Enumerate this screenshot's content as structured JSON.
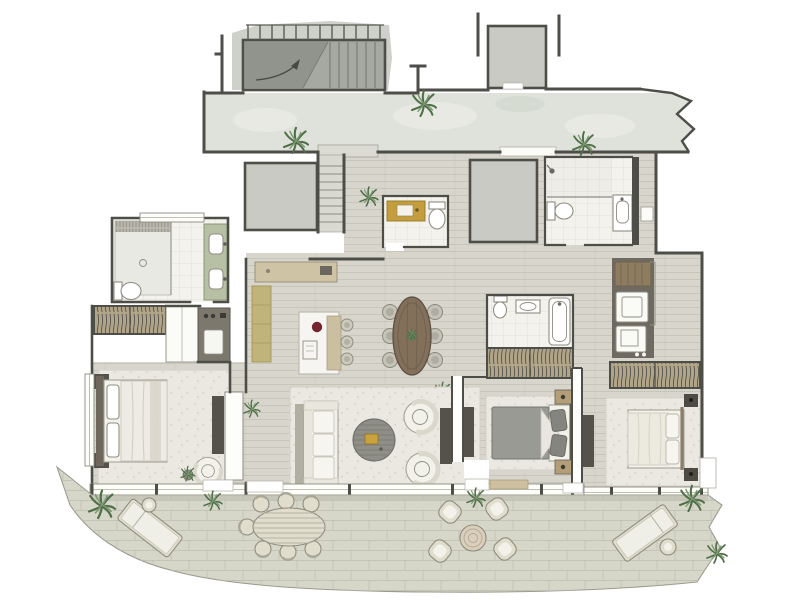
{
  "meta": {
    "type": "architectural-floor-plan",
    "style": "hand-rendered watercolor",
    "canvas": {
      "width": 800,
      "height": 600
    }
  },
  "palette": {
    "wall": "#4e4e48",
    "corridor": "#dee2da",
    "corridor_blotch": "#e8ebe3",
    "gray_block": "#c9cac4",
    "stair_light": "#ced1ca",
    "stair_gray": "#a6a8a2",
    "stair_dark": "#8f918b",
    "wood": "#d8d6cc",
    "plank_line": "#c3c1b5",
    "bath_floor": "#f3f2ed",
    "tile_line": "#dcdad1",
    "green_vanity": "#b7c0a5",
    "yellow_cabinet": "#c0b478",
    "gold_vanity": "#c49d3f",
    "wood_console": "#cfc3a5",
    "island_wood": "#cabfa0",
    "marble": "#f6f5f1",
    "red_bowl": "#74252d",
    "rug": "#eae8e1",
    "speckle": "#cfcdc2",
    "dark_furniture": "#55524b",
    "gray_furniture": "#90908a",
    "bed_white": "#f2f1ea",
    "duvet_gray": "#9a9a94",
    "headboard": "#6f675c",
    "night_tan": "#b49e78",
    "table_wood": "#82705a",
    "chair_gray": "#c6c3b8",
    "terrace": "#d7d7c9",
    "brick_line": "#bcbfae",
    "wicker": "#e0ddcd",
    "closet_tan": "#b0a489",
    "hatch": "#57554d",
    "utility_dark": "#6e6a61",
    "appliance_wood": "#8d7c5f",
    "tray_gold": "#c9a23d",
    "plant_dark": "#4f6f48",
    "plant_light": "#7b9770"
  },
  "plan": {
    "rooms": [
      {
        "name": "Stairwell",
        "furniture": [
          "staircase",
          "railing",
          "direction-arrow"
        ]
      },
      {
        "name": "Shared corridor",
        "furniture": [
          "plant",
          "plant",
          "plant"
        ]
      },
      {
        "name": "Entry hall",
        "furniture": [
          "entry-steps",
          "threshold",
          "plant",
          "shaft-block",
          "shaft-block"
        ]
      },
      {
        "name": "Powder room",
        "furniture": [
          "gold-vanity",
          "toilet"
        ]
      },
      {
        "name": "Guest bathroom",
        "furniture": [
          "shower",
          "toilet",
          "vanity"
        ]
      },
      {
        "name": "Master bathroom",
        "furniture": [
          "walk-in-shower",
          "bench",
          "toilet",
          "double-vanity"
        ]
      },
      {
        "name": "Master bedroom",
        "furniture": [
          "double-bed",
          "nightstand",
          "nightstand",
          "rug",
          "tv-console",
          "armchair",
          "plant",
          "wardrobe",
          "minibar-cabinet",
          "linen-closet"
        ]
      },
      {
        "name": "Kitchen and dining",
        "furniture": [
          "wall-console",
          "tall-cabinet",
          "kitchen-island",
          "bar-stool",
          "bar-stool",
          "bar-stool",
          "oval-dining-table",
          "dining-chairs-x6"
        ]
      },
      {
        "name": "Living room",
        "furniture": [
          "sofa",
          "side-console",
          "round-coffee-table",
          "tray",
          "barrel-armchair",
          "barrel-armchair",
          "rug",
          "media-console",
          "plant"
        ]
      },
      {
        "name": "Bedroom 2",
        "furniture": [
          "double-bed",
          "nightstand",
          "nightstand",
          "rug",
          "tv-console",
          "wardrobe"
        ]
      },
      {
        "name": "En-suite bathroom",
        "furniture": [
          "toilet",
          "vanity",
          "bathtub"
        ]
      },
      {
        "name": "Bedroom 3",
        "furniture": [
          "double-bed",
          "nightstand",
          "nightstand",
          "rug",
          "tv-console",
          "wardrobe",
          "wardrobe"
        ]
      },
      {
        "name": "Utility area",
        "furniture": [
          "cabinet",
          "washer",
          "dryer"
        ]
      },
      {
        "name": "Terrace",
        "furniture": [
          "sun-lounger",
          "side-table",
          "oval-outdoor-table",
          "outdoor-chairs-x7",
          "lounge-chairs-x4",
          "round-patio-table",
          "sun-lounger",
          "side-table",
          "plants"
        ]
      }
    ],
    "counts": {
      "bedrooms": 3,
      "bathrooms": 4,
      "dining_chairs": 6,
      "bar_stools": 3,
      "outdoor_dining_chairs": 7,
      "patio_armchairs": 4,
      "sun_loungers": 2,
      "corridor_plants": 3,
      "terrace_plants": 5
    }
  }
}
